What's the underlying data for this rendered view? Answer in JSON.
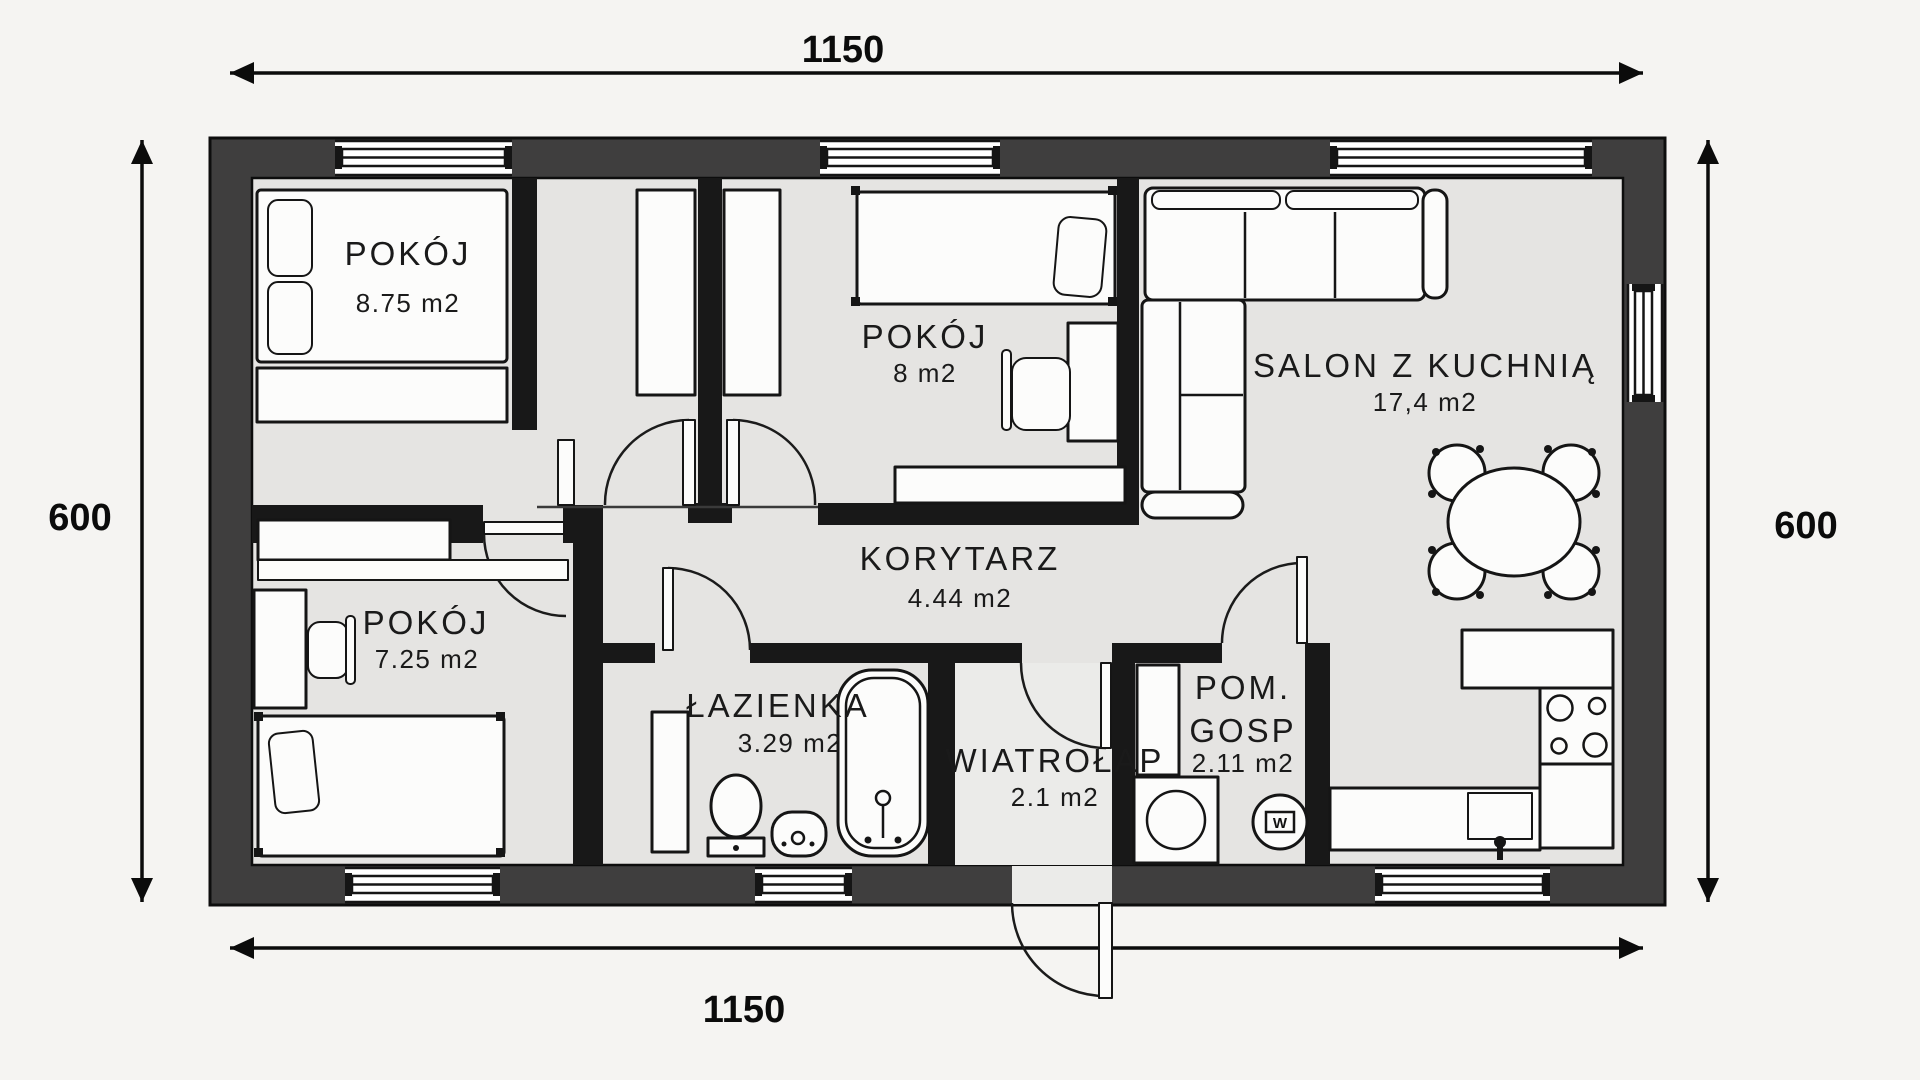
{
  "colors": {
    "background": "#f5f4f2",
    "floor": "#e5e4e2",
    "outer_wall": "#3f3e3e",
    "inner_wall": "#181818",
    "furniture_fill": "#fcfcfb",
    "text": "#1a1a1a"
  },
  "dimensions": {
    "top": "1150",
    "bottom": "1150",
    "left": "600",
    "right": "600"
  },
  "rooms": {
    "bedroom1": {
      "name": "POKÓJ",
      "area": "8.75 m2"
    },
    "bedroom2": {
      "name": "POKÓJ",
      "area": "8 m2"
    },
    "living": {
      "name": "SALON Z KUCHNIĄ",
      "area": "17,4 m2"
    },
    "bedroom3": {
      "name": "POKÓJ",
      "area": "7.25 m2"
    },
    "hall": {
      "name": "KORYTARZ",
      "area": "4.44 m2"
    },
    "bathroom": {
      "name": "ŁAZIENKA",
      "area": "3.29 m2"
    },
    "vestibule": {
      "name": "WIATROŁAP",
      "area": "2.1 m2"
    },
    "utility": {
      "name_line1": "POM.",
      "name_line2": "GOSP",
      "area": "2.11 m2"
    }
  },
  "labels": {
    "water_heater": "W"
  }
}
